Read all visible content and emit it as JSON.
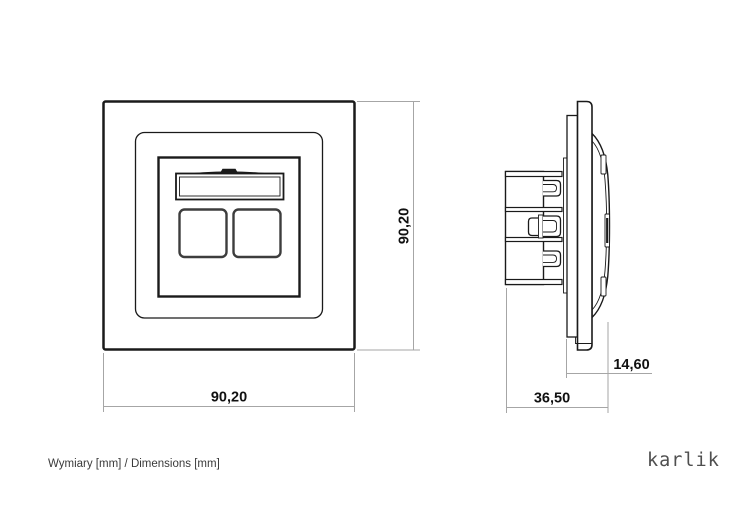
{
  "dimensions": {
    "front_width": "90,20",
    "front_height": "90,20",
    "side_depth": "36,50",
    "side_front_depth": "14,60"
  },
  "footer": {
    "caption": "Wymiary [mm] / Dimensions [mm]",
    "brand": "karlik"
  },
  "colors": {
    "outline": "#1a1a1a",
    "port_outline": "#3d3d3d",
    "dimension_line": "#a6a6a6",
    "dimension_text": "#111111",
    "caption_text": "#3a3a3a",
    "brand_text": "#4f4f4f"
  }
}
